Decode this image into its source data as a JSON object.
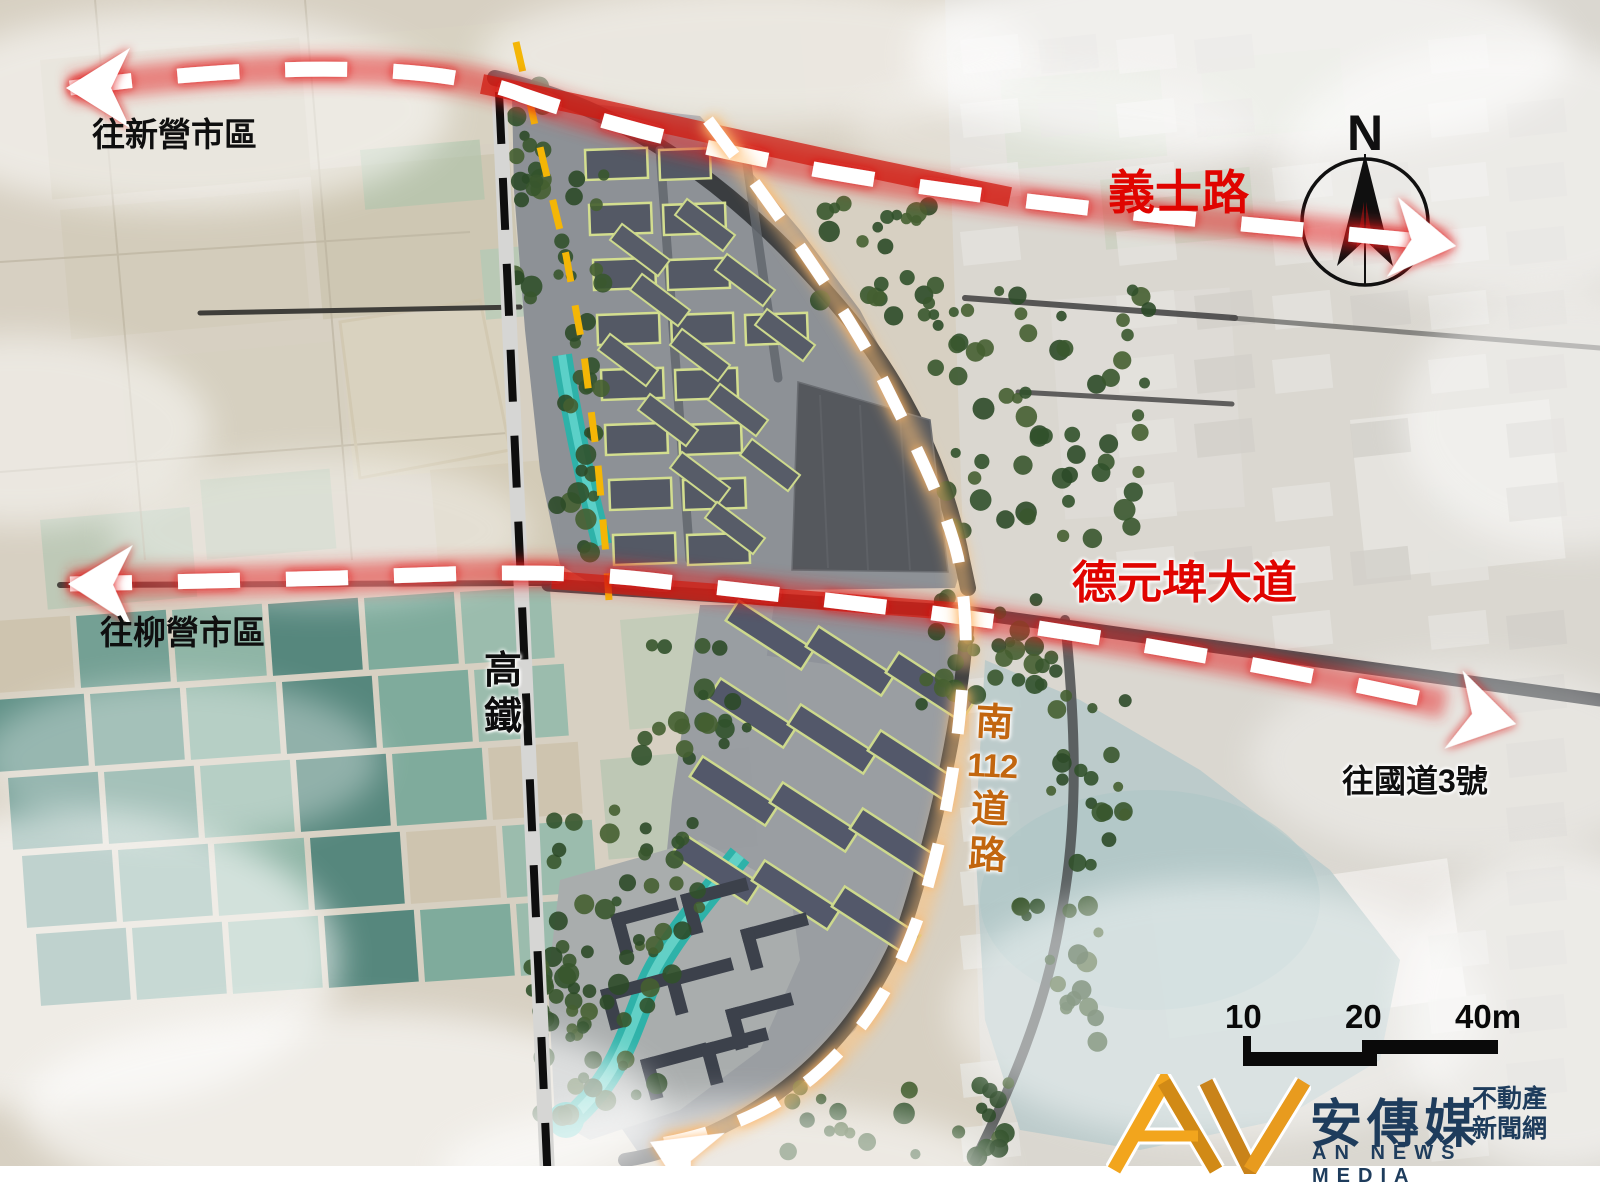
{
  "annotations": {
    "to_xinying": "往新營市區",
    "yishi_road": "義士路",
    "deyuanpi_blvd": "德元埤大道",
    "to_liuying": "往柳營市區",
    "to_highway3": "往國道3號",
    "hsr_chars": [
      "高",
      "鐵"
    ],
    "south112_chars": [
      "南",
      "112",
      "道",
      "路"
    ]
  },
  "compass": {
    "north_label": "N"
  },
  "scale_bar": {
    "tick_10": "10",
    "tick_20": "20",
    "tick_40": "40m"
  },
  "logo": {
    "brand": "安傳媒",
    "tagline_top": "不動產",
    "tagline_bottom": "新聞網",
    "subtitle": "AN NEWS MEDIA"
  },
  "colors": {
    "route_red": "#e01f1f",
    "label_red": "#e00400",
    "gold_dash": "#f4b606",
    "orange_label": "#c2660f",
    "water_teal": "#2eb2a9",
    "hsr_black": "#0e0e0e",
    "logo_gold": "#f2a51d",
    "logo_navy": "#1e3c5c"
  }
}
